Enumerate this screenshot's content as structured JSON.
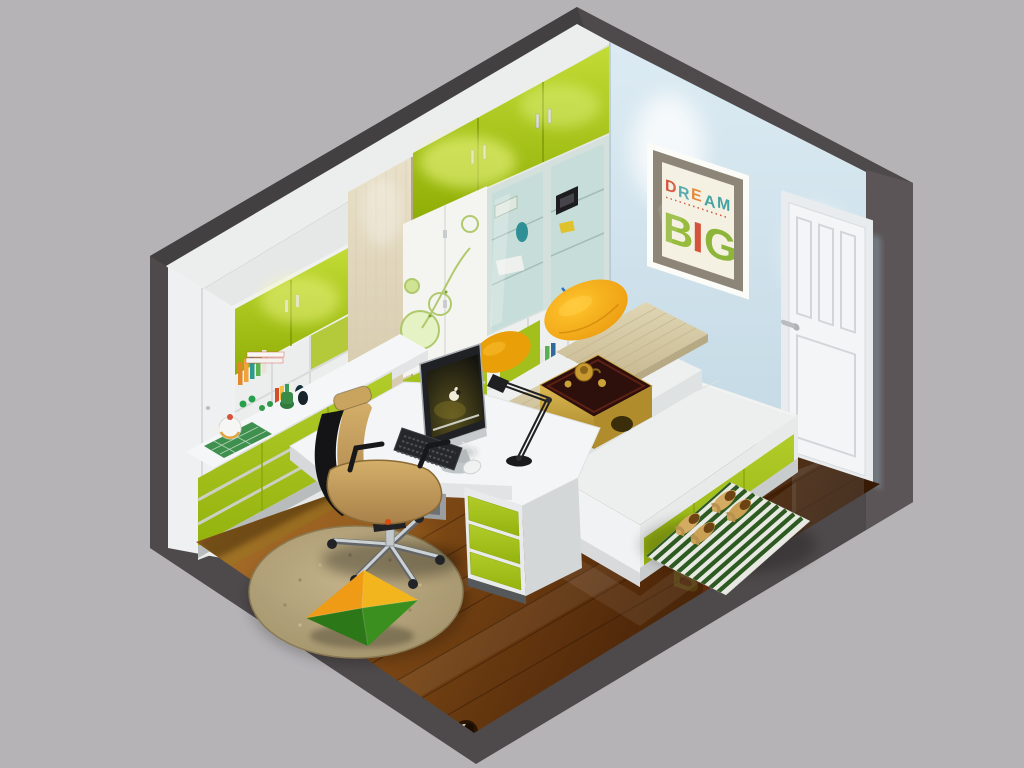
{
  "scene": {
    "description": "3D isometric cutaway render of a compact study bedroom with lime-green and white fitted cabinetry, an L-shaped desk workstation with an iMac, a tatami platform bed with tea table, a white panel door and glossy wood floor",
    "render_background": "#b5b3b6"
  },
  "poster": {
    "name": "DREAM BIG wall art",
    "word1": [
      {
        "ch": "D",
        "color": "#d5533b"
      },
      {
        "ch": "R",
        "color": "#47a2a4"
      },
      {
        "ch": "E",
        "color": "#e2893b"
      },
      {
        "ch": "A",
        "color": "#47a2a4"
      },
      {
        "ch": "M",
        "color": "#47a2a4"
      }
    ],
    "word2": [
      {
        "ch": "B",
        "color": "#97bb3d"
      },
      {
        "ch": "I",
        "color": "#d5533b"
      },
      {
        "ch": "G",
        "color": "#8db53a"
      }
    ]
  },
  "palette": {
    "background": "#b5b3b6",
    "wall_cut_edge": "#4c4748",
    "cabinet_green": "#a6c51e",
    "cabinet_white": "#f1f2f3",
    "wall_blue": "#cfe2ec",
    "floor_wood": "#6e3c12",
    "pillow_yellow": "#f2a60e",
    "chair_tan": "#c7a565",
    "tatami_tan": "#d6cba9",
    "rug_stripe_green": "#2e5c22",
    "door_white": "#f2f3f4"
  },
  "objects": {
    "left_wall": [
      "white wardrobe",
      "green upper cabinet doors",
      "open bookshelf cubbies with books",
      "counter with green base cabinets",
      "white teapot on green mat"
    ],
    "back_wall": [
      "green lacquer top cabinets",
      "floral print white doors",
      "glass display cabinet",
      "open shelves with globe and books",
      "beige textured panel"
    ],
    "right_wall": [
      "DREAM BIG framed poster",
      "white panel door",
      "wall spotlights"
    ],
    "furniture": [
      "L-shaped white desk",
      "iMac computer",
      "black keyboard",
      "white mouse",
      "black desk lamp",
      "green drawer pedestal",
      "tan office chair",
      "tatami platform bed",
      "yellow pillows",
      "dark tea table with gold tray",
      "green striped rug with slippers",
      "round jute rug",
      "green-orange pinwheel cushion"
    ]
  }
}
